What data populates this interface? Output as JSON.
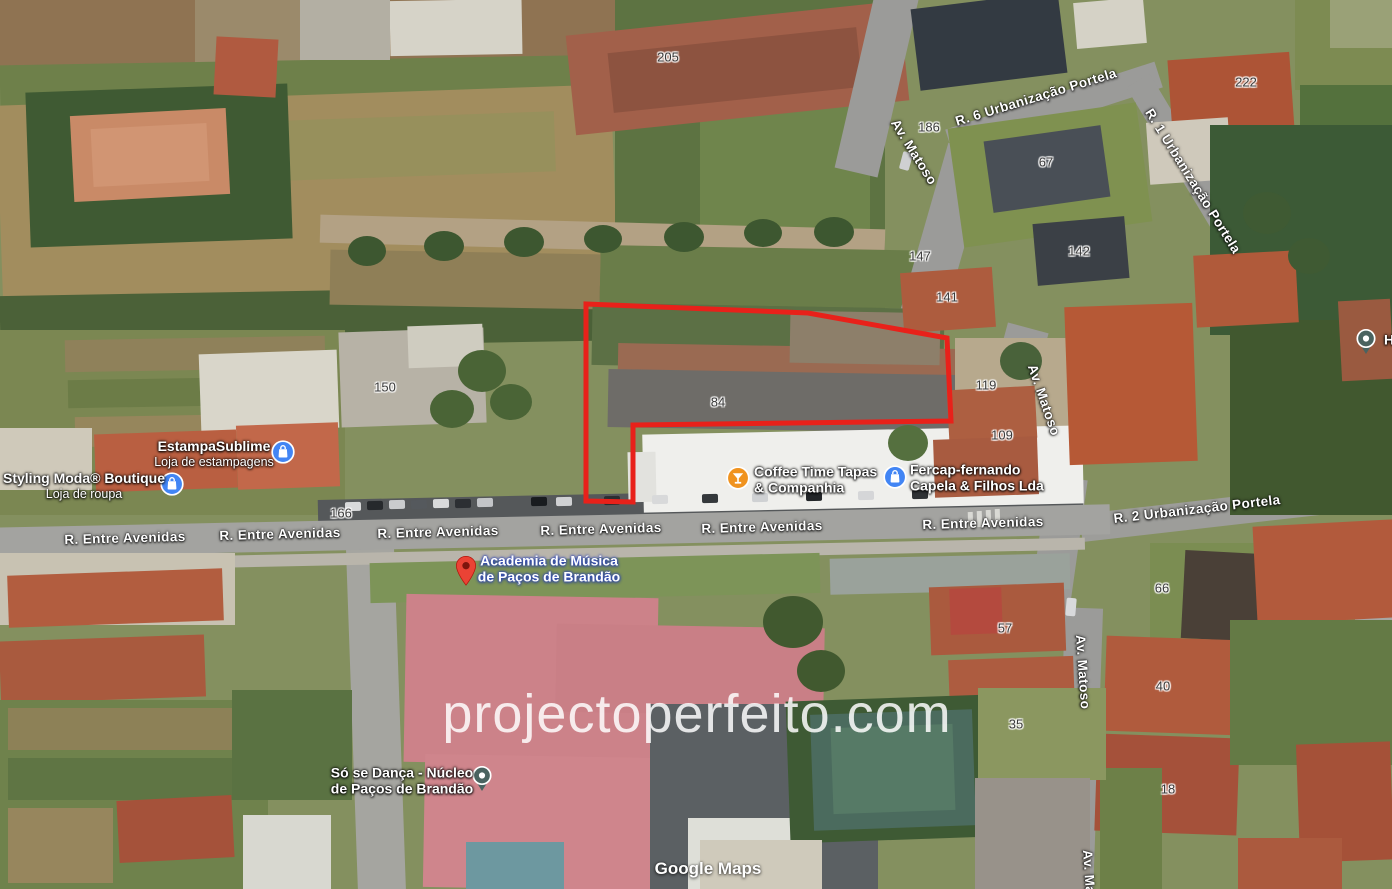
{
  "watermark": {
    "text": "projectoperfeito.com"
  },
  "attribution": {
    "text": "Google Maps"
  },
  "colors": {
    "parcel": "#e8211a",
    "shopping_icon": "#4285f4",
    "drink_icon": "#f0931f",
    "pin_red": "#ea4335",
    "pin_red_dot": "#7e150d",
    "pin_teal": "#4a6360"
  },
  "parcel": {
    "points": [
      [
        586,
        304
      ],
      [
        808,
        313
      ],
      [
        947,
        338
      ],
      [
        951,
        421
      ],
      [
        633,
        425
      ],
      [
        633,
        502
      ],
      [
        586,
        501
      ]
    ]
  },
  "streets": [
    {
      "text": "R. Entre Avenidas",
      "x": 125,
      "y": 538,
      "rot": -1.5
    },
    {
      "text": "R. Entre Avenidas",
      "x": 280,
      "y": 534,
      "rot": -1.5
    },
    {
      "text": "R. Entre Avenidas",
      "x": 438,
      "y": 532,
      "rot": -1.5
    },
    {
      "text": "R. Entre Avenidas",
      "x": 601,
      "y": 529,
      "rot": -1.5
    },
    {
      "text": "R. Entre Avenidas",
      "x": 762,
      "y": 527,
      "rot": -1.5
    },
    {
      "text": "R. Entre Avenidas",
      "x": 983,
      "y": 523,
      "rot": -1.5
    },
    {
      "text": "R. 2 Urbanização Portela",
      "x": 1197,
      "y": 509,
      "rot": -6.5
    },
    {
      "text": "R. 6 Urbanização Portela",
      "x": 1036,
      "y": 97,
      "rot": -17
    },
    {
      "text": "R. 1 Urbanização Portela",
      "x": 1193,
      "y": 181,
      "rot": 58
    },
    {
      "text": "Av. Matoso",
      "x": 914,
      "y": 152,
      "rot": 58
    },
    {
      "text": "Av. Matoso",
      "x": 1044,
      "y": 400,
      "rot": 71
    },
    {
      "text": "Av. Matoso",
      "x": 1083,
      "y": 672,
      "rot": 86
    },
    {
      "text": "Av. Matoso",
      "x": 1090,
      "y": 887,
      "rot": 86
    }
  ],
  "building_numbers": [
    {
      "text": "205",
      "x": 668,
      "y": 57
    },
    {
      "text": "186",
      "x": 929,
      "y": 127
    },
    {
      "text": "222",
      "x": 1246,
      "y": 82
    },
    {
      "text": "67",
      "x": 1046,
      "y": 162
    },
    {
      "text": "147",
      "x": 920,
      "y": 256
    },
    {
      "text": "142",
      "x": 1079,
      "y": 251
    },
    {
      "text": "141",
      "x": 947,
      "y": 297
    },
    {
      "text": "150",
      "x": 385,
      "y": 387
    },
    {
      "text": "119",
      "x": 986,
      "y": 385
    },
    {
      "text": "109",
      "x": 1002,
      "y": 435
    },
    {
      "text": "84",
      "x": 718,
      "y": 402
    },
    {
      "text": "166",
      "x": 341,
      "y": 513
    },
    {
      "text": "66",
      "x": 1162,
      "y": 588
    },
    {
      "text": "57",
      "x": 1005,
      "y": 628
    },
    {
      "text": "40",
      "x": 1163,
      "y": 686
    },
    {
      "text": "35",
      "x": 1016,
      "y": 724
    },
    {
      "text": "18",
      "x": 1168,
      "y": 789
    }
  ],
  "pois": [
    {
      "name_lines": [
        "Styling Moda® Boutique"
      ],
      "subtitle": "Loja de roupa",
      "icon": "shopping",
      "icon_x": 172,
      "icon_y": 484,
      "text_x": 84,
      "text_y": 486,
      "align": "center",
      "style": "white"
    },
    {
      "name_lines": [
        "EstampaSublime"
      ],
      "subtitle": "Loja de estampagens",
      "icon": "shopping",
      "icon_x": 283,
      "icon_y": 452,
      "text_x": 214,
      "text_y": 454,
      "align": "center",
      "style": "white"
    },
    {
      "name_lines": [
        "Coffee Time Tapas",
        "& Companhia"
      ],
      "subtitle": null,
      "icon": "drink",
      "icon_x": 738,
      "icon_y": 478,
      "text_x": 754,
      "text_y": 480,
      "align": "left",
      "style": "white"
    },
    {
      "name_lines": [
        "Fercap-fernando",
        "Capela & Filhos Lda"
      ],
      "subtitle": null,
      "icon": "shopping",
      "icon_x": 895,
      "icon_y": 477,
      "text_x": 910,
      "text_y": 478,
      "align": "left",
      "style": "white"
    },
    {
      "name_lines": [
        "Academia de Música",
        "de Paços de Brandão"
      ],
      "subtitle": null,
      "icon": "pin-red",
      "icon_x": 466,
      "icon_y": 566,
      "text_x": 549,
      "text_y": 569,
      "align": "center",
      "style": "blue"
    },
    {
      "name_lines": [
        "Só se Dança - Núcleo",
        "de Paços de Brandão"
      ],
      "subtitle": null,
      "icon": "pin-teal",
      "icon_x": 482,
      "icon_y": 776,
      "text_x": 402,
      "text_y": 781,
      "align": "center",
      "style": "white"
    },
    {
      "name_lines": [
        "H"
      ],
      "subtitle": null,
      "icon": "pin-teal",
      "icon_x": 1366,
      "icon_y": 339,
      "text_x": 1384,
      "text_y": 340,
      "align": "left",
      "style": "white"
    }
  ]
}
